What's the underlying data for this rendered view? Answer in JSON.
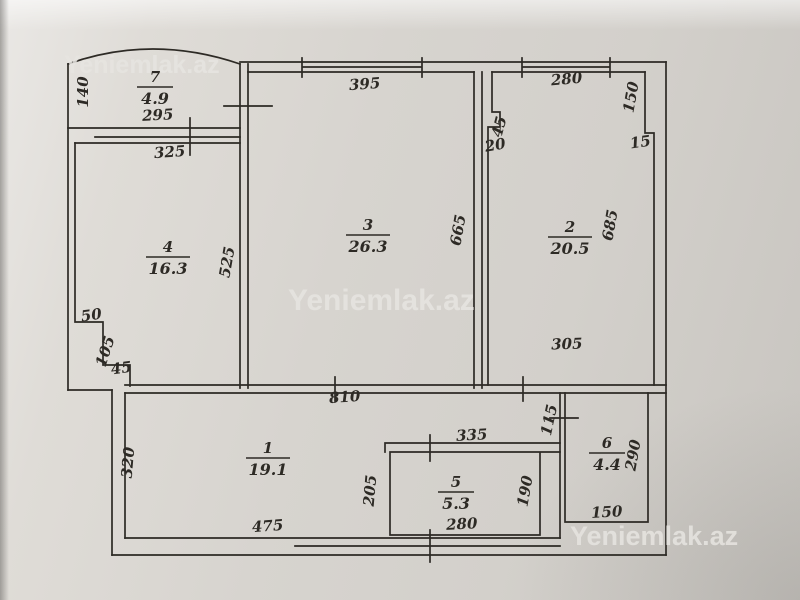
{
  "plan": {
    "ink_color": "#2d2a25",
    "paper_color": "#d7d4cf",
    "watermark_color": "#e7e5e1",
    "watermarks": [
      {
        "text": "Yeniemlak.az",
        "x": 64,
        "y": 73,
        "size": 25
      },
      {
        "text": "Yeniemlak.az",
        "x": 288,
        "y": 310,
        "size": 30
      },
      {
        "text": "Yeniemlak.az",
        "x": 570,
        "y": 545,
        "size": 27
      }
    ],
    "rooms": [
      {
        "number": "7",
        "area": "4.9",
        "x": 155,
        "y": 82
      },
      {
        "number": "4",
        "area": "16.3",
        "x": 168,
        "y": 252
      },
      {
        "number": "3",
        "area": "26.3",
        "x": 368,
        "y": 230
      },
      {
        "number": "2",
        "area": "20.5",
        "x": 570,
        "y": 232
      },
      {
        "number": "1",
        "area": "19.1",
        "x": 268,
        "y": 453
      },
      {
        "number": "5",
        "area": "5.3",
        "x": 456,
        "y": 487
      },
      {
        "number": "6",
        "area": "4.4",
        "x": 607,
        "y": 448
      }
    ],
    "dimensions": [
      {
        "text": "140",
        "x": 88,
        "y": 92,
        "rotate": -90
      },
      {
        "text": "295",
        "x": 158,
        "y": 120,
        "rotate": -3
      },
      {
        "text": "325",
        "x": 170,
        "y": 157,
        "rotate": -4
      },
      {
        "text": "395",
        "x": 365,
        "y": 89,
        "rotate": -4
      },
      {
        "text": "280",
        "x": 567,
        "y": 84,
        "rotate": -5
      },
      {
        "text": "45",
        "x": 504,
        "y": 128,
        "rotate": -75
      },
      {
        "text": "20",
        "x": 496,
        "y": 150,
        "rotate": -10
      },
      {
        "text": "150",
        "x": 636,
        "y": 98,
        "rotate": -80
      },
      {
        "text": "15",
        "x": 641,
        "y": 147,
        "rotate": -8
      },
      {
        "text": "665",
        "x": 463,
        "y": 231,
        "rotate": -80
      },
      {
        "text": "685",
        "x": 615,
        "y": 226,
        "rotate": -80
      },
      {
        "text": "525",
        "x": 232,
        "y": 263,
        "rotate": -80
      },
      {
        "text": "305",
        "x": 567,
        "y": 349,
        "rotate": -2
      },
      {
        "text": "50",
        "x": 92,
        "y": 320,
        "rotate": -8
      },
      {
        "text": "105",
        "x": 110,
        "y": 353,
        "rotate": -72
      },
      {
        "text": "45",
        "x": 122,
        "y": 373,
        "rotate": -8
      },
      {
        "text": "810",
        "x": 345,
        "y": 402,
        "rotate": -4
      },
      {
        "text": "320",
        "x": 133,
        "y": 463,
        "rotate": -85
      },
      {
        "text": "335",
        "x": 472,
        "y": 440,
        "rotate": -3
      },
      {
        "text": "115",
        "x": 554,
        "y": 421,
        "rotate": -78
      },
      {
        "text": "205",
        "x": 375,
        "y": 491,
        "rotate": -85
      },
      {
        "text": "190",
        "x": 530,
        "y": 492,
        "rotate": -80
      },
      {
        "text": "290",
        "x": 638,
        "y": 456,
        "rotate": -80
      },
      {
        "text": "475",
        "x": 268,
        "y": 531,
        "rotate": -4
      },
      {
        "text": "280",
        "x": 462,
        "y": 529,
        "rotate": -3
      },
      {
        "text": "150",
        "x": 607,
        "y": 517,
        "rotate": -3
      }
    ]
  }
}
